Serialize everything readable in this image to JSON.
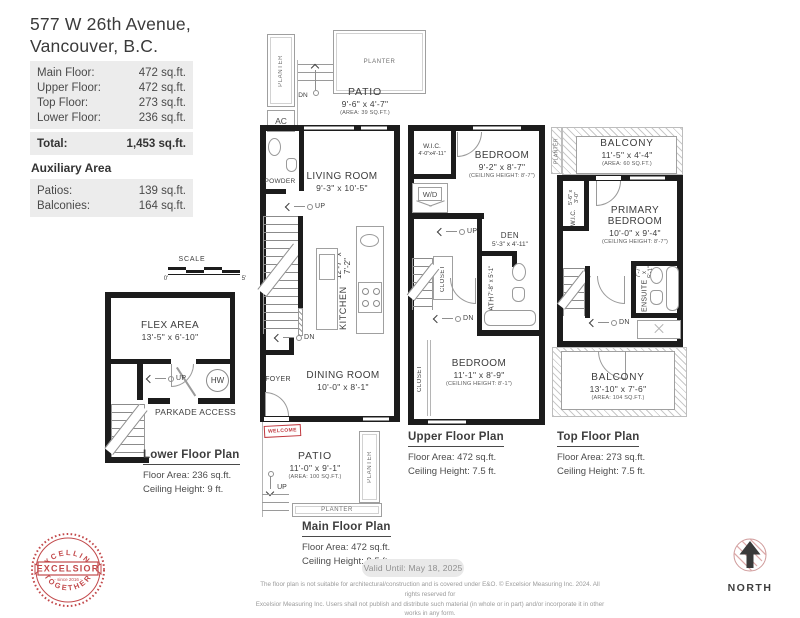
{
  "colors": {
    "wall": "#1c1c1c",
    "line": "#9a9a9a",
    "accent_red": "#c0393f",
    "logo_red": "#c2494b",
    "text_dark": "#3d3d3d",
    "table_bg": "#ececec"
  },
  "header": {
    "address_line1": "577 W 26th Avenue,",
    "address_line2": "Vancouver, B.C.",
    "area_rows": [
      {
        "label": "Main Floor:",
        "value": "472 sq.ft."
      },
      {
        "label": "Upper Floor:",
        "value": "472 sq.ft."
      },
      {
        "label": "Top Floor:",
        "value": "273 sq.ft."
      },
      {
        "label": "Lower Floor:",
        "value": "236 sq.ft."
      }
    ],
    "total_row": {
      "label": "Total:",
      "value": "1,453 sq.ft."
    },
    "auxiliary_title": "Auxiliary Area",
    "auxiliary_rows": [
      {
        "label": "Patios:",
        "value": "139 sq.ft."
      },
      {
        "label": "Balconies:",
        "value": "164 sq.ft."
      }
    ]
  },
  "scale": {
    "label": "SCALE",
    "zero": "0'",
    "five": "5'"
  },
  "plans": {
    "lower": {
      "title": "Lower Floor Plan",
      "floor_area": "Floor Area: 236 sq.ft.",
      "ceiling": "Ceiling Height: 9 ft.",
      "flex": {
        "name": "FLEX AREA",
        "dims": "13'-5\" x 6'-10\""
      },
      "parkade": "PARKADE ACCESS",
      "hw": "HW",
      "up": "UP"
    },
    "main": {
      "title": "Main Floor Plan",
      "floor_area": "Floor Area: 472 sq.ft.",
      "ceiling": "Ceiling Height: 8.5 ft.",
      "planter": "PLANTER",
      "ac": "AC",
      "dn": "DN",
      "up": "UP",
      "patio_top": {
        "name": "PATIO",
        "dims": "9'-6\" x 4'-7\"",
        "area": "(AREA: 39 SQ.FT.)"
      },
      "powder": "POWDER",
      "living": {
        "name": "LIVING ROOM",
        "dims": "9'-3\" x 10'-5\""
      },
      "kitchen": {
        "name": "KITCHEN",
        "dims": "12'-7\" x 7'-2\""
      },
      "foyer": "FOYER",
      "dining": {
        "name": "DINING ROOM",
        "dims": "10'-0\" x 8'-1\""
      },
      "welcome": "WELCOME",
      "patio_bottom": {
        "name": "PATIO",
        "dims": "11'-0\" x 9'-1\"",
        "area": "(AREA: 100 SQ.FT.)"
      }
    },
    "upper": {
      "title": "Upper Floor Plan",
      "floor_area": "Floor Area: 472 sq.ft.",
      "ceiling": "Ceiling Height: 7.5 ft.",
      "wic": {
        "name": "W.I.C.",
        "dims": "4'-0\"x4'-11\""
      },
      "bedroom1": {
        "name": "BEDROOM",
        "dims": "9'-2\" x 8'-7\"",
        "ceiling": "(CEILING HEIGHT: 8'-7\")"
      },
      "wd": "W/D",
      "up": "UP",
      "dn": "DN",
      "den": {
        "name": "DEN",
        "dims": "5'-3\" x 4'-11\""
      },
      "closet_hall": "CLOSET",
      "bath": {
        "name": "BATH",
        "dims": "7'-8\" x 5'-1\""
      },
      "bedroom2": {
        "name": "BEDROOM",
        "dims": "11'-1\" x 8'-9\"",
        "ceiling": "(CEILING HEIGHT: 8'-1\")"
      },
      "closet_bedroom": "CLOSET"
    },
    "top": {
      "title": "Top Floor Plan",
      "floor_area": "Floor Area: 273 sq.ft.",
      "ceiling": "Ceiling Height: 7.5 ft.",
      "planter": "PLANTER",
      "dn": "DN",
      "balcony_top": {
        "name": "BALCONY",
        "dims": "11'-5\" x 4'-4\"",
        "area": "(AREA: 60 SQ.FT.)"
      },
      "wic": {
        "name": "W.I.C.",
        "dims": "5'-6\" x 3'-0\""
      },
      "primary": {
        "name": "PRIMARY BEDROOM",
        "dims": "10'-0\" x 9'-4\"",
        "ceiling": "(CEILING HEIGHT: 8'-7\")"
      },
      "ensuite": {
        "name": "ENSUITE",
        "dims": "7'-7\" x 5'-1\""
      },
      "balcony_bottom": {
        "name": "BALCONY",
        "dims": "13'-10\" x 7'-6\"",
        "area": "(AREA: 104 SQ.FT.)"
      }
    }
  },
  "footer": {
    "valid_until": "Valid Until: May 18, 2025",
    "disclaimer_line1": "The floor plan is not suitable for architectural/construction and is covered under E&O. © Excelsior Measuring Inc. 2024. All rights reserved for",
    "disclaimer_line2": "Excelsior Measuring Inc. Users shall not publish and distribute such material (in whole or in part) and/or incorporate it in other works in any form.",
    "north_label": "NORTH",
    "logo": {
      "arc_top": "EXCELLING",
      "banner": "EXCELSIOR",
      "arc_bottom": "TOGETHER",
      "since": "- since 2016 -"
    }
  }
}
